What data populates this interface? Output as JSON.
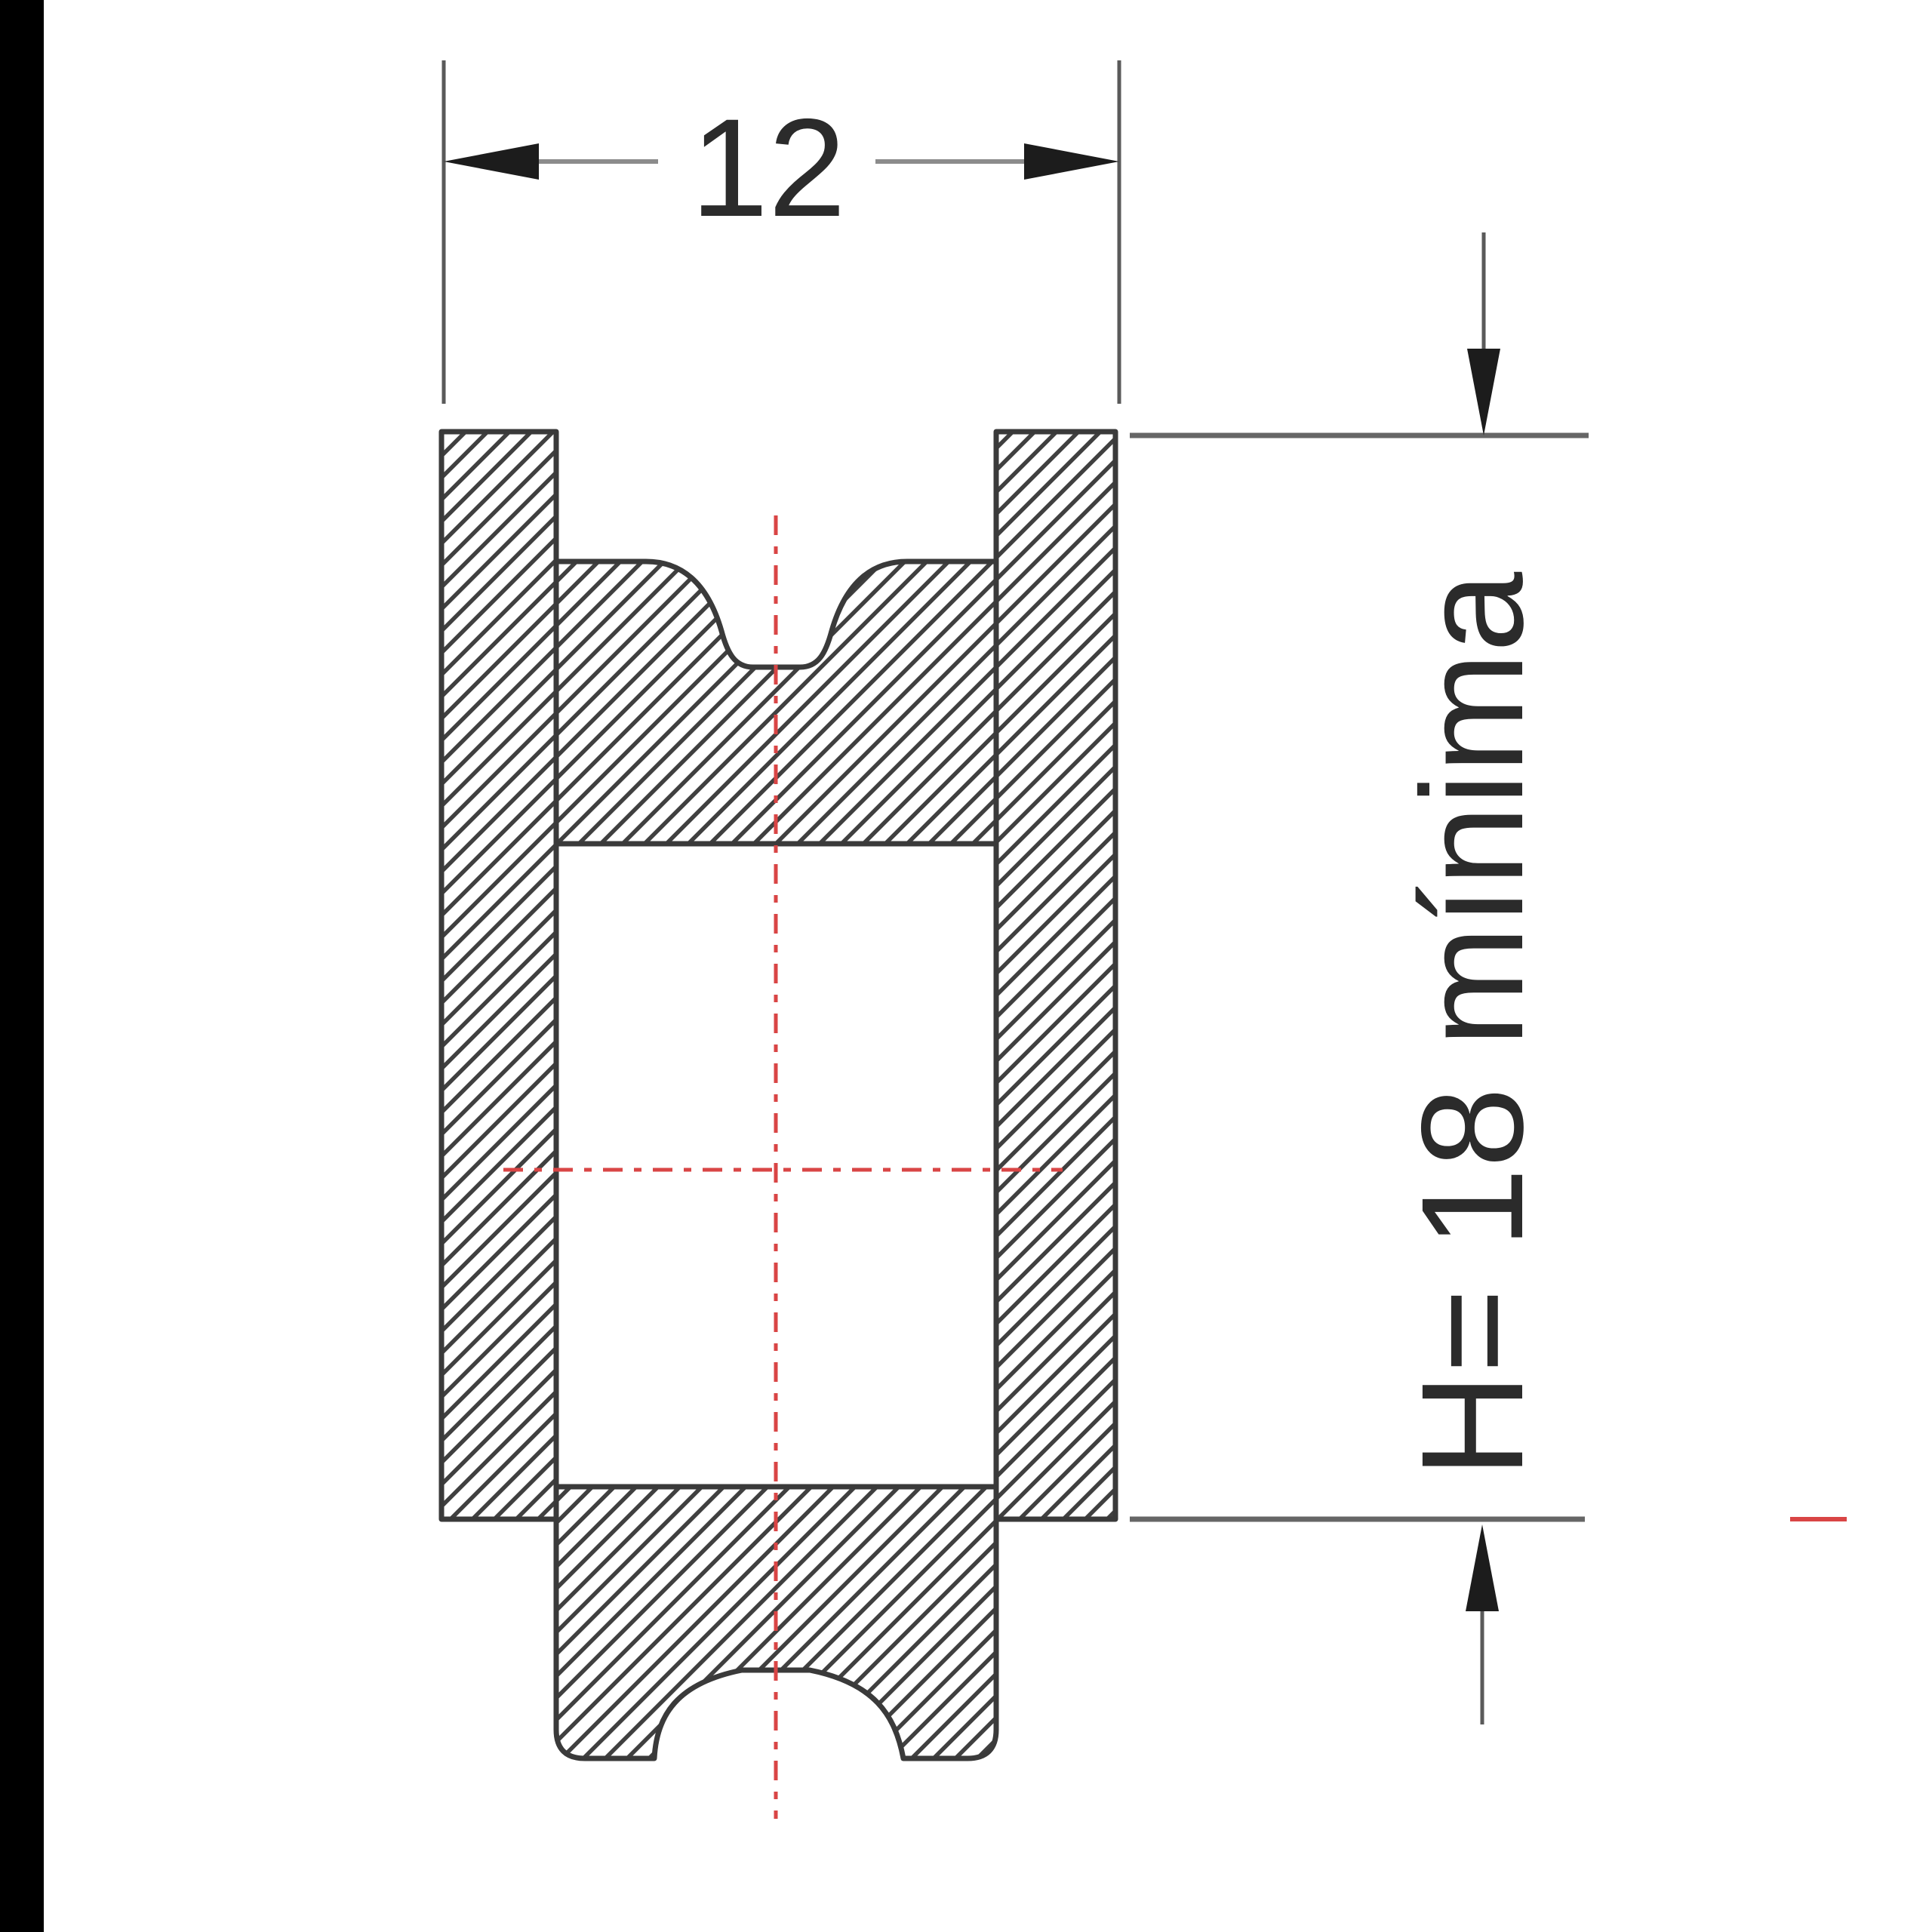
{
  "drawing": {
    "kind": "pulley-sheave-cross-section",
    "width_dimension": {
      "label": "12"
    },
    "height_dimension": {
      "label": "H= 18 mínima"
    },
    "colors": {
      "background": "#ffffff",
      "edge_bar": "#000000",
      "outline": "#3a3a3a",
      "hatch": "#404040",
      "centerline": "#d94545",
      "dim_line": "#8c8c8c",
      "dim_line_dark": "#5a5a5a",
      "dim_dark": "#1c1c1c",
      "ref_line": "#666666",
      "text": "#2b2b2b"
    }
  }
}
